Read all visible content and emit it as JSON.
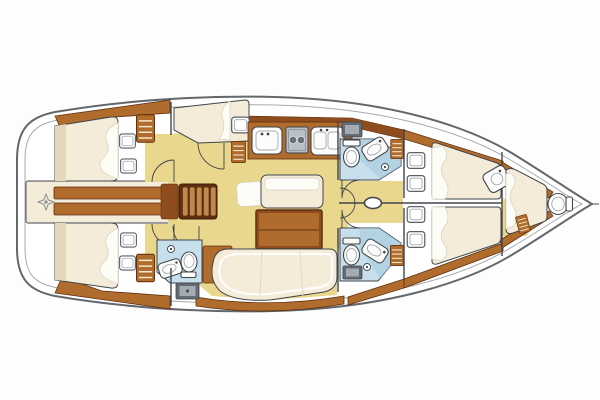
{
  "meta": {
    "description": "Sailing yacht interior floor plan, top-down view, bow to the right, five cabins and three heads, no text labels"
  },
  "colors": {
    "background": "#fdfdfd",
    "deck_white": "#ffffff",
    "hull_outline": "#63686d",
    "hull_inner": "#a6aaae",
    "floor_yellow": "#e8d78c",
    "wood": "#b06c2c",
    "wood_dark": "#8f4d1d",
    "wood_deep": "#5f2f10",
    "steps_light": "#c08a4e",
    "bed_cream": "#f4ecd9",
    "bed_shade": "#e5d8ba",
    "cushion_white": "#fdfdf8",
    "bath_blue": "#c6dfeb",
    "bath_blue_dark": "#a4c9da",
    "fixture_white": "#fcfcfb",
    "gray_fixture": "#a4abb3",
    "gray_dark": "#646b74",
    "line_dark": "#40454b",
    "compass_gray": "#8a8f94"
  },
  "legend": {
    "rooms": [
      "stern-platform",
      "aft-cabin-port",
      "aft-cabin-starboard",
      "companionway",
      "galley",
      "saloon",
      "day-head",
      "head-port",
      "head-starboard",
      "mast-corridor",
      "forward-cabin-port",
      "forward-cabin-starboard",
      "bow-cabin"
    ],
    "fixture_icons": [
      "compass-rose-icon",
      "double-berth",
      "pillow",
      "deck-hatch",
      "louvered-locker",
      "companionway-steps",
      "galley-sink",
      "two-burner-stove",
      "double-sink",
      "saloon-table",
      "settee",
      "bench",
      "stool",
      "toilet",
      "washbasin",
      "shower-pan",
      "shower-head",
      "door-swing",
      "mast",
      "bulkhead"
    ]
  }
}
